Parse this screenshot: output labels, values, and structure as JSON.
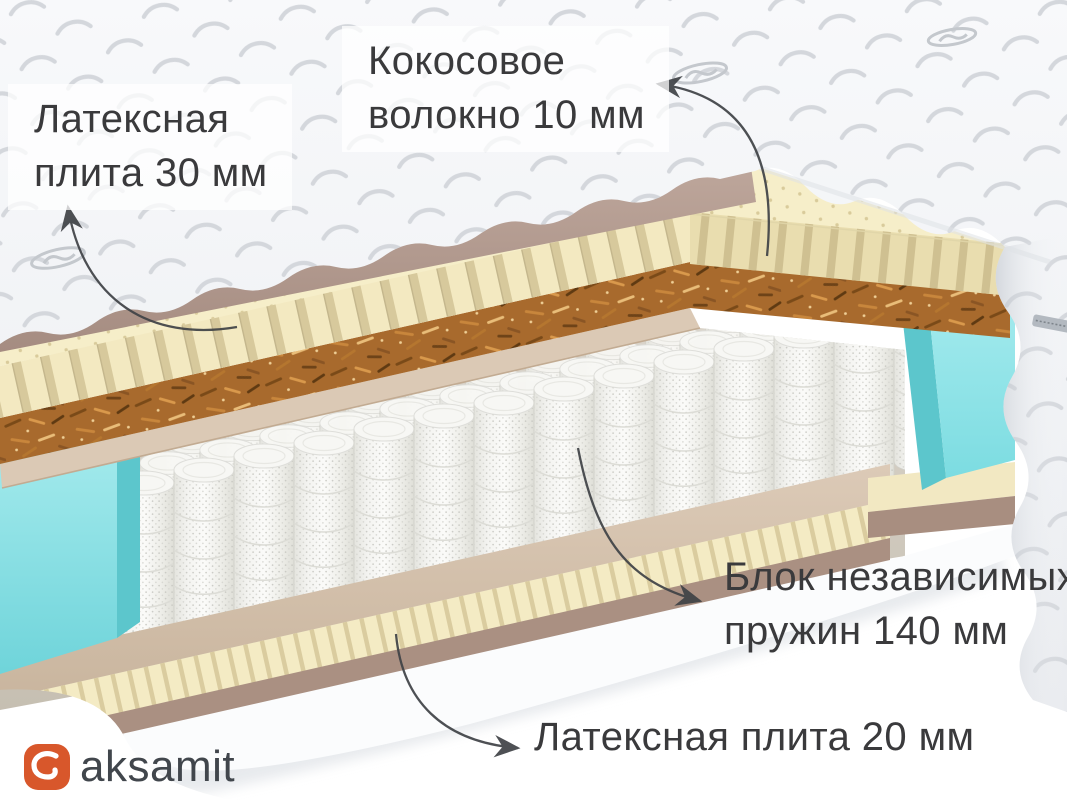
{
  "annotations": {
    "latex_top": {
      "line1": "Латексная",
      "line2": "плита 30 мм"
    },
    "coconut": {
      "line1": "Кокосовое",
      "line2": "волокно 10 мм"
    },
    "springs": {
      "line1": "Блок независимых",
      "line2": "пружин 140 мм"
    },
    "latex_bottom": {
      "text": "Латексная плита  20 мм"
    }
  },
  "logo": {
    "text": "aksamit"
  },
  "colors": {
    "logo_orange": "#D8572B",
    "accent_teal": "#8FE2E5",
    "coconut_brown": "#A86A2E",
    "latex_cream": "#F4EBC4",
    "cover_white": "#F4F5F7",
    "base_taupe": "#AA9082",
    "arrow": "#3F4246",
    "text_dark": "#3A3A3C"
  }
}
